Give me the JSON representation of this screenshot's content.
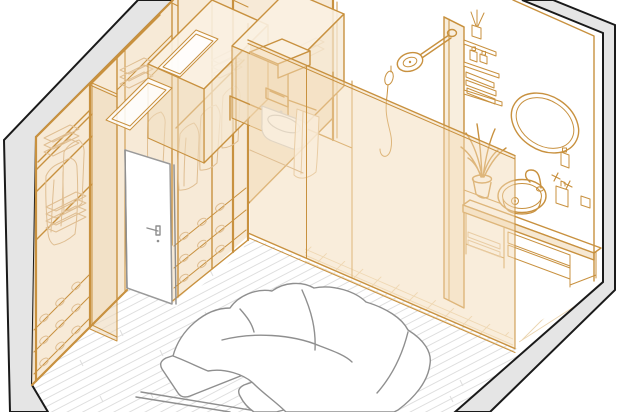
{
  "scene": {
    "description": "Isometric cutaway illustration of a bedroom with a walk-in wardrobe and en-suite bathroom, drawn as an orange architectural wireframe on white",
    "style": "axonometric line drawing",
    "objects": [
      {
        "name": "left-wall",
        "label": "Cutaway wall, top-left"
      },
      {
        "name": "right-wall",
        "label": "Cutaway wall, right and bottom-right"
      },
      {
        "name": "wood-floor",
        "label": "Diagonal plank flooring"
      },
      {
        "name": "wardrobe",
        "label": "Walk-in wardrobe with shelves, folded clothes, hanging rails and shoe racks"
      },
      {
        "name": "upper-cabinets",
        "label": "Overhead storage boxes"
      },
      {
        "name": "closet-door",
        "label": "Open white door with handle"
      },
      {
        "name": "toilet",
        "label": "Wall-hung toilet with cistern shelf and towel bar"
      },
      {
        "name": "shower-glass-wall",
        "label": "Tinted glass shower partition"
      },
      {
        "name": "shower-head",
        "label": "Wall-mounted rain shower head"
      },
      {
        "name": "hand-shower",
        "label": "Hand shower with hose"
      },
      {
        "name": "bathroom-shelves",
        "label": "Wall shelf unit with bottles, diffuser and towels"
      },
      {
        "name": "mirror",
        "label": "Oval mirror"
      },
      {
        "name": "vanity",
        "label": "Floating vanity with vessel sink, faucet and drawers"
      },
      {
        "name": "plant",
        "label": "Potted plant on shelf"
      },
      {
        "name": "bed",
        "label": "Double bed with duvet and two pillows"
      }
    ]
  },
  "colors": {
    "line_orange": "#C8913F",
    "line_light": "#DFBE92",
    "fill_cream": "#F6E8D3",
    "fill_cream_dark": "#EFDBBC",
    "fill_cream_top": "#FAF1E2",
    "glass_tint": "rgba(243,219,183,0.5)",
    "wall_gray": "#E5E5E5",
    "outline_black": "#1A1A1A",
    "furniture_gray": "#8F8F8F",
    "floor_line": "#DEDEDE",
    "tile_line": "#EBD5B0",
    "white": "#FFFFFF"
  }
}
